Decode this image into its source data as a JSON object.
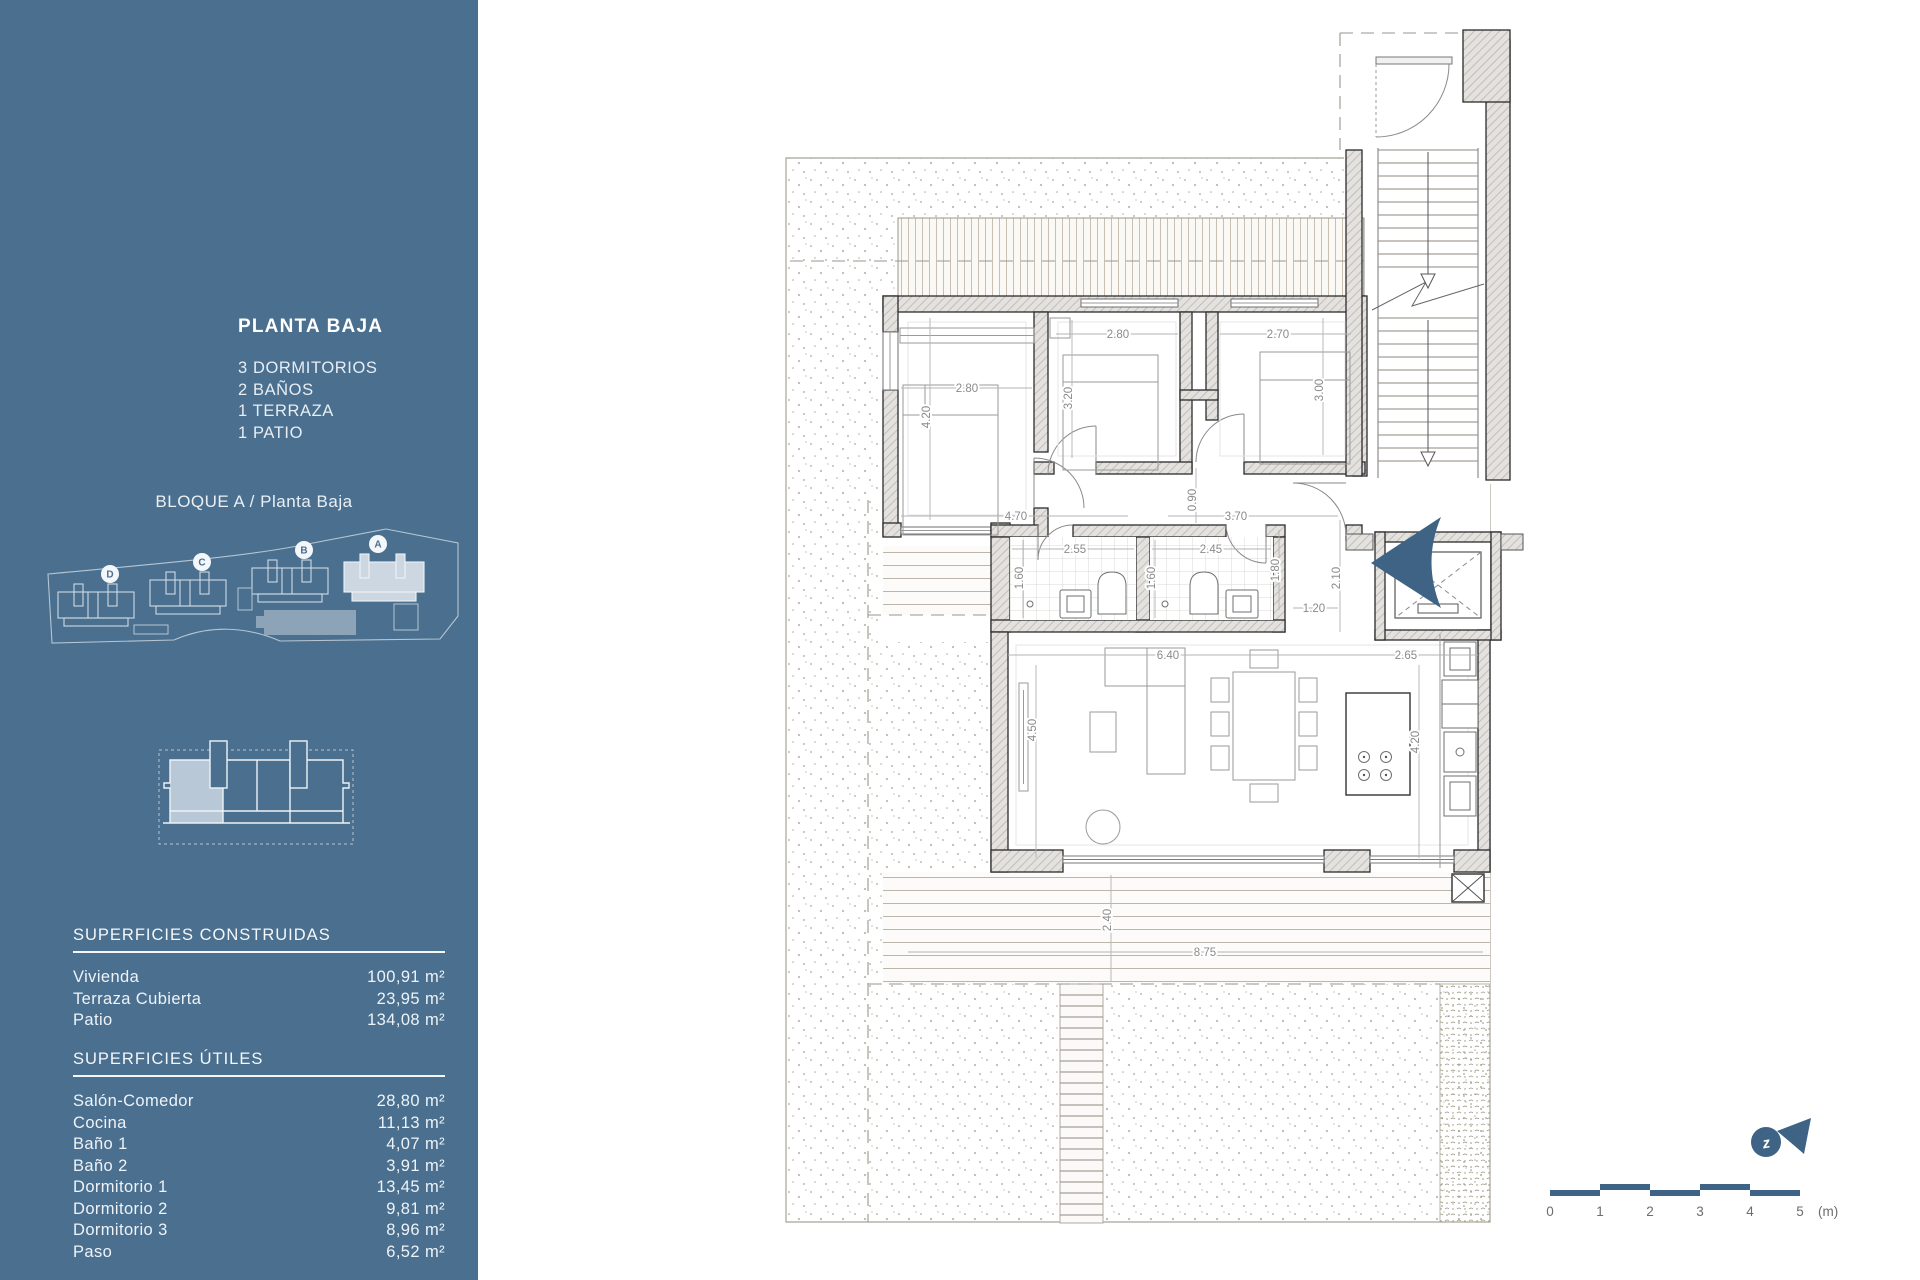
{
  "sidebar": {
    "accent_color": "#4a6f8f",
    "title": "PLANTA BAJA",
    "features": [
      "3 DORMITORIOS",
      "2 BAÑOS",
      "1 TERRAZA",
      "1 PATIO"
    ],
    "block_label": "BLOQUE A / Planta Baja",
    "site_buildings": [
      "D",
      "C",
      "B",
      "A"
    ],
    "apartment_label": "Apartamento 1A",
    "tables": [
      {
        "heading": "SUPERFICIES CONSTRUIDAS",
        "rows": [
          {
            "label": "Vivienda",
            "value": "100,91 m²"
          },
          {
            "label": "Terraza Cubierta",
            "value": "23,95 m²"
          },
          {
            "label": "Patio",
            "value": "134,08 m²"
          }
        ]
      },
      {
        "heading": "SUPERFICIES ÚTILES",
        "rows": [
          {
            "label": "Salón-Comedor",
            "value": "28,80 m²"
          },
          {
            "label": "Cocina",
            "value": "11,13 m²"
          },
          {
            "label": "Baño 1",
            "value": "4,07 m²"
          },
          {
            "label": "Baño 2",
            "value": "3,91 m²"
          },
          {
            "label": "Dormitorio 1",
            "value": "13,45 m²"
          },
          {
            "label": "Dormitorio 2",
            "value": "9,81 m²"
          },
          {
            "label": "Dormitorio 3",
            "value": "8,96 m²"
          },
          {
            "label": "Paso",
            "value": "6,52 m²"
          }
        ]
      }
    ]
  },
  "plan": {
    "dims": {
      "bedroom1_width": "2.80",
      "bedroom1_depth": "4.20",
      "bedroom2_width": "2.80",
      "bedroom2_depth": "3.20",
      "bedroom3_width": "2.70",
      "bedroom3_depth": "3.00",
      "hall_width": "4.70",
      "hall_depth": "0.90",
      "hall_east": "3.70",
      "bath1_width": "2.55",
      "bath1_depth": "1.60",
      "bath2_width": "2.45",
      "bath2_depth": "1.60",
      "paso_depth": "1.80",
      "entry_width": "1.20",
      "entry_depth": "2.10",
      "living_width": "6.40",
      "kitchen_width": "2.65",
      "living_depth": "4.50",
      "kitchen_depth": "4.20",
      "terrace_depth": "2.40",
      "terrace_width": "8.75"
    },
    "scale_bar": {
      "labels": [
        "0",
        "1",
        "2",
        "3",
        "4",
        "5"
      ],
      "unit": "(m)"
    },
    "compass": {
      "letter": "z"
    },
    "accent_blue": "#3e6385"
  }
}
